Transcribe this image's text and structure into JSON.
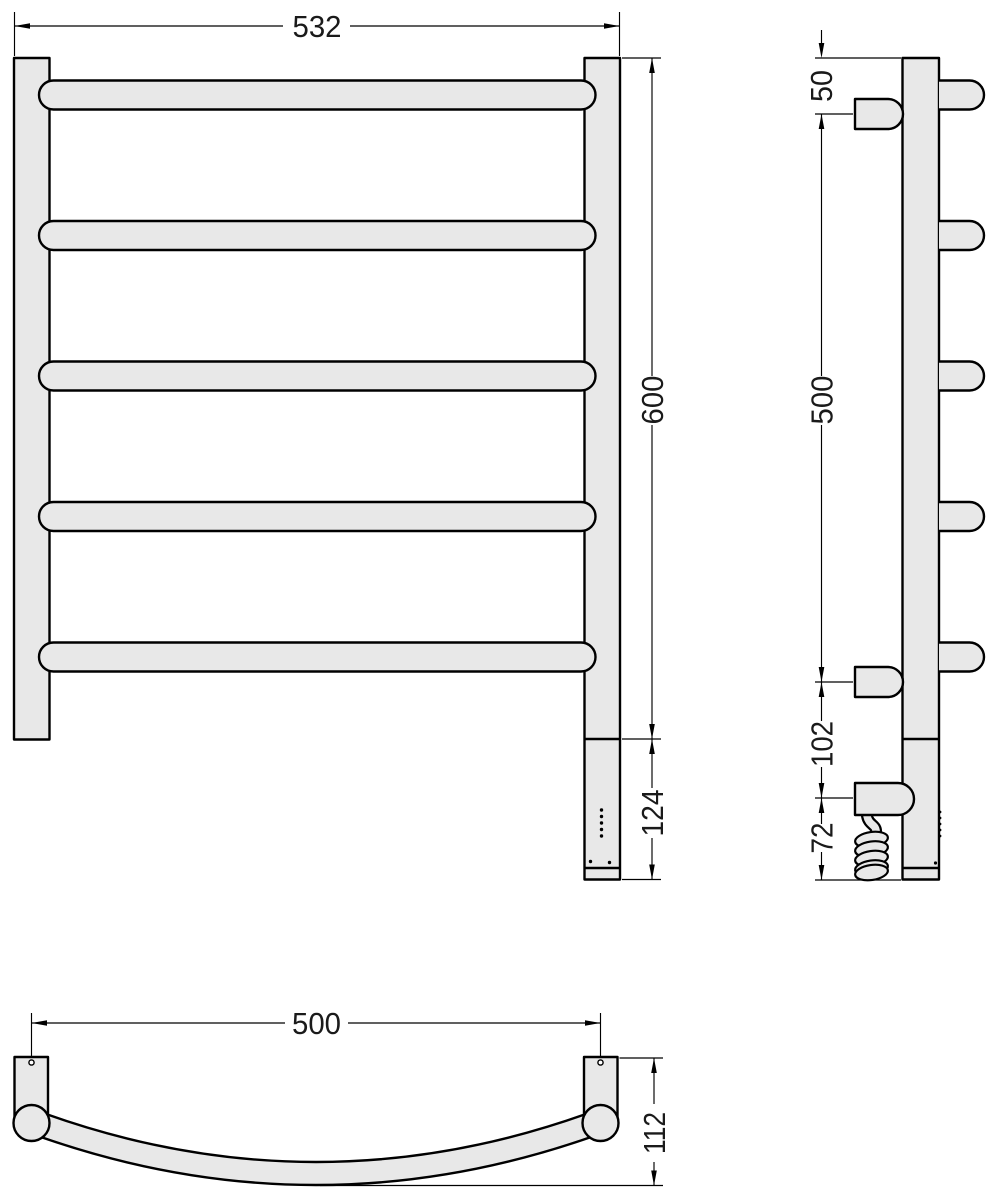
{
  "drawing": {
    "type": "technical-dimension-drawing",
    "subject": "ladder towel rail with heating element - three orthographic views",
    "colors": {
      "fill": "#e8e8e8",
      "line": "#000000",
      "background": "#ffffff"
    },
    "front_view": {
      "bar_count": 5,
      "width": "532",
      "height": "600",
      "heater_section": "124"
    },
    "side_view": {
      "bracket_count": 3,
      "top_offset": "50",
      "bracket_span": "500",
      "bracket_to_plug": "102",
      "cable_section": "72"
    },
    "bottom_view": {
      "bracket_span": "500",
      "depth": "112"
    }
  }
}
